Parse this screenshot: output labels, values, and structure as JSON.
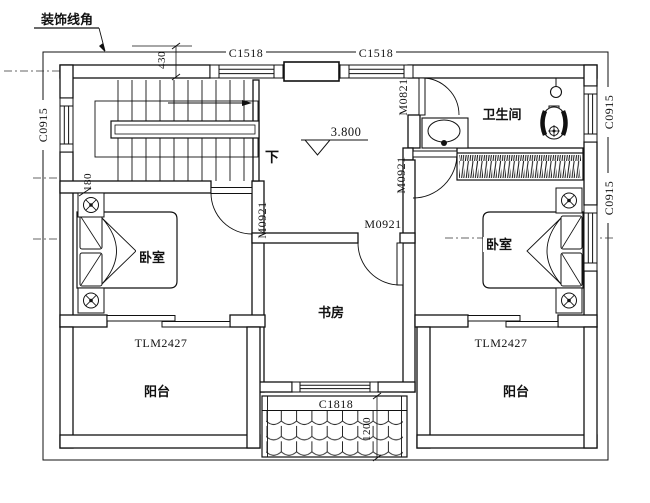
{
  "drawing": {
    "decor_note": "装饰线角",
    "elevation_marker": "3.800",
    "stair_direction": "下"
  },
  "dims": {
    "top": "430",
    "left": "180",
    "canopy": "1200"
  },
  "rooms": {
    "bathroom": "卫生间",
    "bedroom_left": "卧室",
    "bedroom_right": "卧室",
    "study": "书房",
    "balcony_left": "阳台",
    "balcony_right": "阳台"
  },
  "openings": {
    "window_top_left": "C1518",
    "window_top_right": "C1518",
    "window_left": "C0915",
    "window_right_bath": "C0915",
    "window_right_bedroom": "C0915",
    "window_study": "C1818",
    "door_bathroom": "M0821",
    "door_bedroom_left": "M0921",
    "door_bedroom_right": "M0921",
    "door_study": "M0921",
    "balcony_door_left": "TLM2427",
    "balcony_door_right": "TLM2427"
  },
  "colors": {
    "line": "#111111",
    "background": "#ffffff"
  }
}
